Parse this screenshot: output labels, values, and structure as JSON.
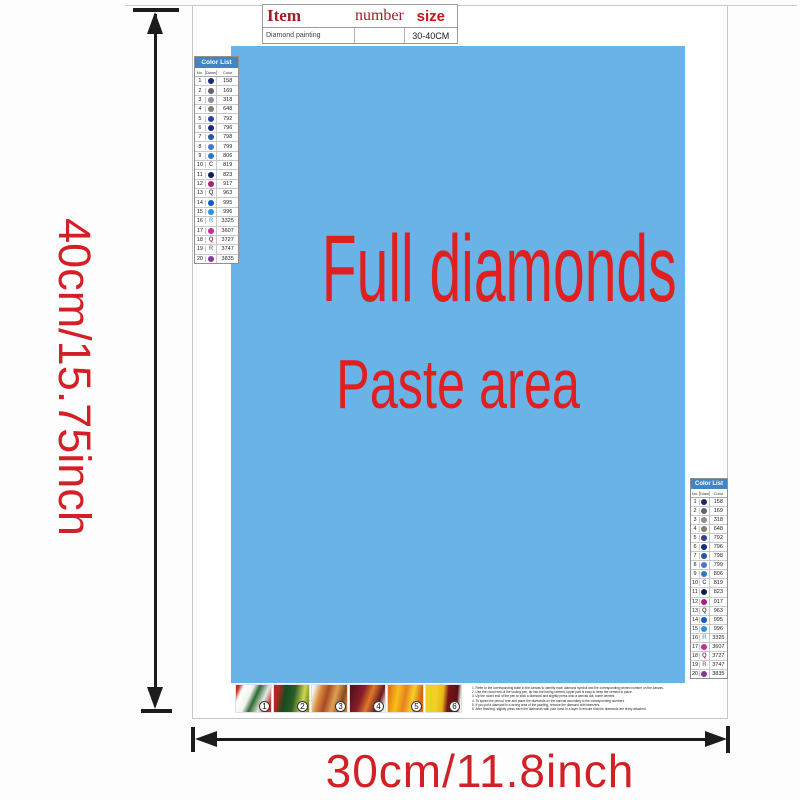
{
  "dimensions": {
    "height_label": "40cm/15.75inch",
    "width_label": "30cm/11.8inch"
  },
  "item_table": {
    "headers": [
      "Item",
      "number",
      "size"
    ],
    "row": {
      "item": "Diamond painting",
      "number": "",
      "size": "30-40CM"
    }
  },
  "paste_area": {
    "line1": "Full diamonds",
    "line2": "Paste area",
    "bg_color": "#69b3e7",
    "text_color": "#e02020"
  },
  "color_list": {
    "title": "Color List",
    "columns": [
      "No.",
      "Diamond",
      "Color"
    ],
    "rows": [
      {
        "no": "1",
        "symbol": "circle",
        "symbol_color": "#1b2a70",
        "code": "158"
      },
      {
        "no": "2",
        "symbol": "circle",
        "symbol_color": "#63636b",
        "code": "169"
      },
      {
        "no": "3",
        "symbol": "circle",
        "symbol_color": "#8e8e96",
        "code": "318"
      },
      {
        "no": "4",
        "symbol": "circle",
        "symbol_color": "#7f7f72",
        "code": "648"
      },
      {
        "no": "5",
        "symbol": "circle",
        "symbol_color": "#2e3f94",
        "code": "792"
      },
      {
        "no": "6",
        "symbol": "circle",
        "symbol_color": "#18297e",
        "code": "796"
      },
      {
        "no": "7",
        "symbol": "circle",
        "symbol_color": "#2c52b0",
        "code": "798"
      },
      {
        "no": "8",
        "symbol": "circle",
        "symbol_color": "#4a74cf",
        "code": "799"
      },
      {
        "no": "9",
        "symbol": "circle",
        "symbol_color": "#2a7abf",
        "code": "806"
      },
      {
        "no": "10",
        "symbol": "letter",
        "letter": "C",
        "symbol_color": "#5a5a64",
        "code": "819"
      },
      {
        "no": "11",
        "symbol": "circle",
        "symbol_color": "#101c55",
        "code": "823"
      },
      {
        "no": "12",
        "symbol": "circle",
        "symbol_color": "#ad2079",
        "code": "917"
      },
      {
        "no": "13",
        "symbol": "letter",
        "letter": "Q",
        "symbol_color": "#4a4a55",
        "code": "963"
      },
      {
        "no": "14",
        "symbol": "circle",
        "symbol_color": "#0b5bc8",
        "code": "995"
      },
      {
        "no": "15",
        "symbol": "circle",
        "symbol_color": "#2f8fe0",
        "code": "996"
      },
      {
        "no": "16",
        "symbol": "letter",
        "letter": "R",
        "symbol_color": "#74aede",
        "code": "3325"
      },
      {
        "no": "17",
        "symbol": "circle",
        "symbol_color": "#bf2f96",
        "code": "3607"
      },
      {
        "no": "18",
        "symbol": "letter",
        "letter": "Q",
        "symbol_color": "#9c2c50",
        "code": "3727"
      },
      {
        "no": "19",
        "symbol": "letter",
        "letter": "R",
        "symbol_color": "#8a8a92",
        "code": "3747"
      },
      {
        "no": "20",
        "symbol": "circle",
        "symbol_color": "#86399b",
        "code": "3835"
      }
    ]
  },
  "footer": {
    "steps": [
      {
        "num": "1",
        "gradient": "linear-gradient(115deg,#cc3326 8%,#ffffff 18%,#f2f2ee 38%,#2e6b33 52%,#e8e8e2 72%,#b93a2e 90%)"
      },
      {
        "num": "2",
        "gradient": "linear-gradient(100deg,#b5271f 12%,#174a20 32%,#2a5d26 55%,#cfd64e 80%,#7a8f2a 95%)"
      },
      {
        "num": "3",
        "gradient": "linear-gradient(105deg,#f4f4f0 6%,#d98a3a 24%,#a84a28 42%,#e0a050 62%,#8a4a22 82%,#c87838 95%)"
      },
      {
        "num": "4",
        "gradient": "linear-gradient(110deg,#5a1220 10%,#8a1e28 35%,#e07828 55%,#6a1822 78%,#f0f0ea 94%)"
      },
      {
        "num": "5",
        "gradient": "linear-gradient(100deg,#e07818 5%,#f8c018 28%,#e88020 48%,#f8d028 68%,#d86810 88%)"
      },
      {
        "num": "6",
        "gradient": "linear-gradient(95deg,#f0d020 30%,#e8b818 48%,#7a1418 62%,#5a1014 86%,#f5f5f0 97%)"
      }
    ],
    "instructions": [
      "1. Refer to the corresponding table in the canvas to identify each diamond symbol and the corresponding printed number on the canvas.",
      "2. Use the round end of the tooling pen, tip into the boring cement, upper part is easy to keep the cement in place.",
      "3. Up the round end of the pen to stick a diamond and slightly press onto a canvas dot, some cement.",
      "4. To speed the period, tear and place the diamonds on the canvas according to the corresponding numbers.",
      "5. If you put a diamond in a wrong area of the painting, remove the diamond with tweezers.",
      "6. After finishing, slightly press each the diamonds with your hand in a layer to ensure that the diamonds are firmly attached."
    ]
  }
}
